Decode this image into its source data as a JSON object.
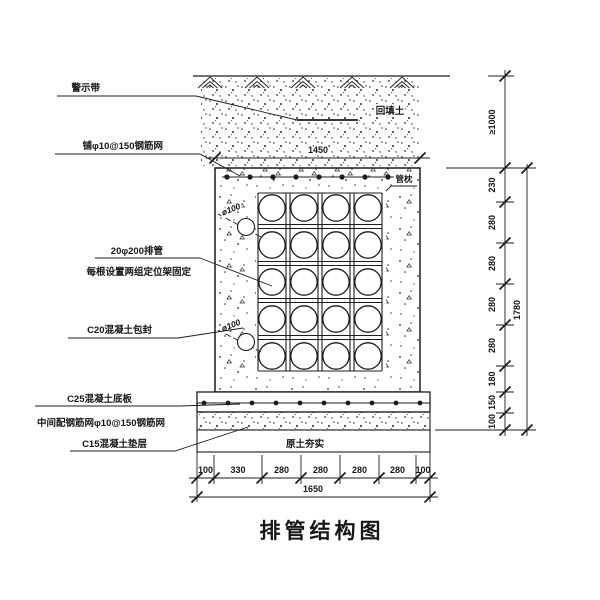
{
  "title": "排管结构图",
  "callouts": {
    "warning_tape": "警示带",
    "top_mesh": "铺φ10@150钢筋网",
    "pipes": "20φ200排管",
    "pipes_note": "每根设置两组定位架固定",
    "encasement": "C20混凝土包封",
    "base_slab": "C25混凝土底板",
    "base_slab_mesh": "中间配钢筋网φ10@150钢筋网",
    "cushion": "C15混凝土垫层"
  },
  "annotations": {
    "backfill": "回填土",
    "pipe_pillow": "管枕",
    "rammed_soil": "原土夯实",
    "drain_upper": "ø100",
    "drain_lower": "ø100"
  },
  "dims": {
    "top_width": "1450",
    "cover_depth": "≥1000",
    "right": [
      "230",
      "280",
      "280",
      "280",
      "280",
      "180",
      "150",
      "100"
    ],
    "right_total": "1780",
    "bottom": [
      "100",
      "330",
      "280",
      "280",
      "280",
      "280",
      "100"
    ],
    "bottom_total": "1650"
  },
  "structure": {
    "pipe_rows": 5,
    "pipe_cols": 4
  },
  "colors": {
    "ink": "#1c1c1c",
    "paper": "#ffffff"
  }
}
